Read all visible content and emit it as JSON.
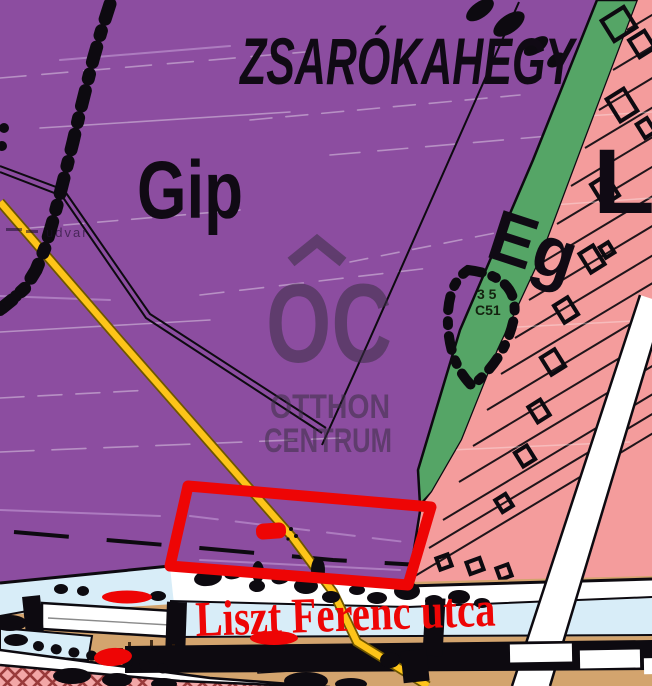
{
  "map": {
    "area_labels": {
      "hill_name": "ZSARÓKAHEGY",
      "zone_gip": "Gip",
      "zone_eg": "Eg",
      "zone_lk": "Lk"
    },
    "street_label": "Liszt Ferenc utca",
    "parcel_note": {
      "line1": "3 5",
      "line2": "C51"
    },
    "faint_label": "udvar"
  },
  "watermark": {
    "monogram": "OC",
    "line1": "OTTHON",
    "line2": "CENTRUM"
  },
  "colors": {
    "purple": "#8c4da0",
    "green": "#55a566",
    "pink": "#f49c9c",
    "yellow": "#fdc419",
    "yellow_edge": "#6e5600",
    "red": "#ee0505",
    "tan": "#d3a46e",
    "lightblue": "#d8edf8",
    "ink": "#0d0a10",
    "watermark": "#3c2f45",
    "hatch_line": "#993b3b",
    "streak_light": "#c8a3da"
  }
}
